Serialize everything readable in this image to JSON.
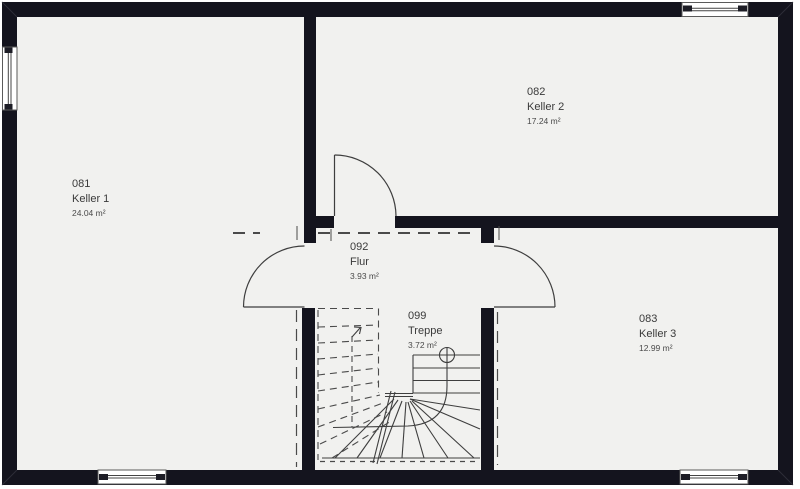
{
  "plan": {
    "title": "Kellergeschoss Grundriss",
    "rooms": [
      {
        "id": "081",
        "name": "Keller 1",
        "area": "24.04 m²"
      },
      {
        "id": "082",
        "name": "Keller 2",
        "area": "17.24 m²"
      },
      {
        "id": "083",
        "name": "Keller 3",
        "area": "12.99 m²"
      },
      {
        "id": "092",
        "name": "Flur",
        "area": "3.93 m²"
      },
      {
        "id": "099",
        "name": "Treppe",
        "area": "3.72 m²"
      }
    ],
    "colors": {
      "wall": "#14141e",
      "floor": "#f1f1ef",
      "line": "#3e3e3e",
      "dashed_line": "#4a4a4a",
      "text": "#3a3a3a",
      "background": "#ffffff",
      "window_fill": "#ffffff"
    }
  }
}
